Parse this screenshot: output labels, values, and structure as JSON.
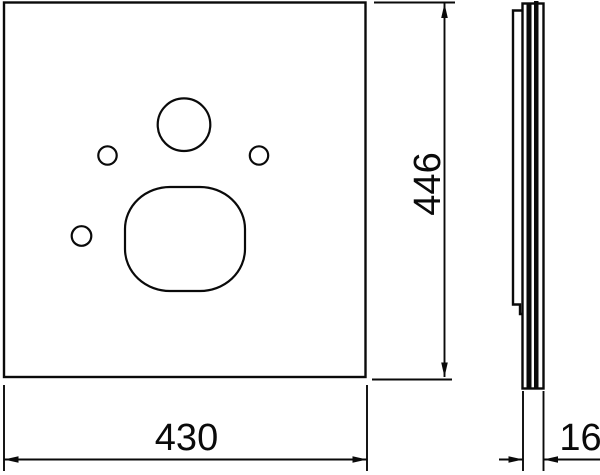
{
  "drawing": {
    "kind": "technical-dimension-drawing",
    "background_color": "#ffffff",
    "line_color": "#0a0a0a"
  },
  "dimensions": {
    "width": "430",
    "height": "446",
    "thickness": "16"
  }
}
